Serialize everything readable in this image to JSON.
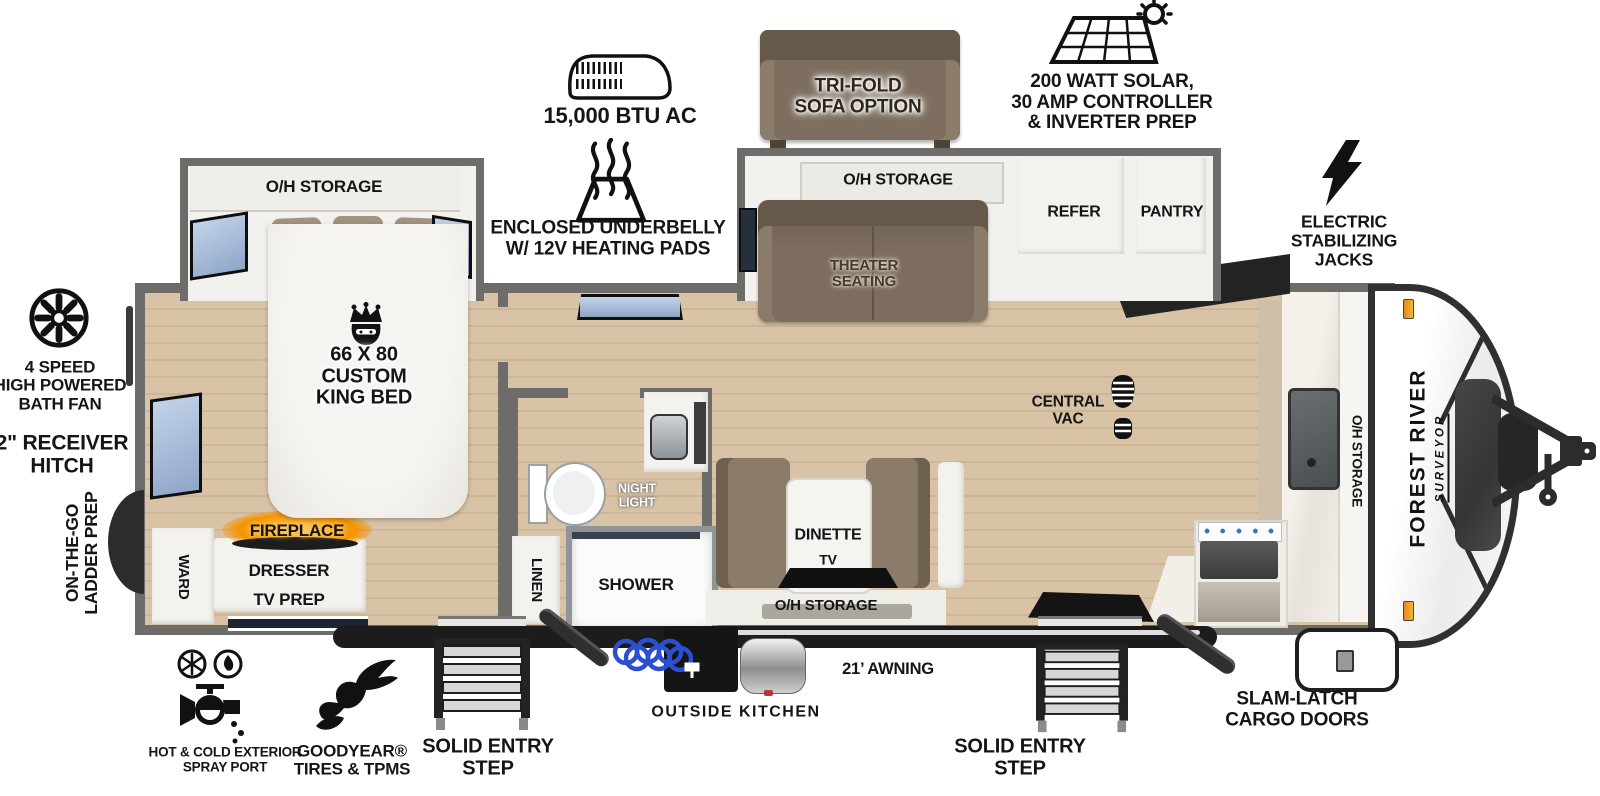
{
  "title": "Travel trailer floorplan",
  "colors": {
    "wall": "#6e6c68",
    "floor": "#d9c3a6",
    "floor_line": "#cdb698",
    "furniture_brown": "#7f7164",
    "window_blue": "#a9bdd9",
    "fireplace_orange": "#f59300",
    "accent_dark": "#1c1c1c"
  },
  "callouts": {
    "ac": "15,000 BTU AC",
    "underbelly": "ENCLOSED UNDERBELLY\nW/ 12V HEATING PADS",
    "trifold_sofa": "TRI-FOLD\nSOFA OPTION",
    "solar": "200 WATT SOLAR,\n30 AMP CONTROLLER\n& INVERTER PREP",
    "stabilizing_jacks": "ELECTRIC\nSTABILIZING\nJACKS",
    "bath_fan": "4 SPEED\nHIGH POWERED\nBATH FAN",
    "receiver_hitch": "2\" RECEIVER\nHITCH",
    "ladder_prep": "ON-THE-GO\nLADDER PREP",
    "spray_port": "HOT & COLD EXTERIOR\nSPRAY PORT",
    "tires": "GOODYEAR®\nTIRES & TPMS",
    "entry_step_left": "SOLID ENTRY\nSTEP",
    "outside_kitchen": "OUTSIDE KITCHEN",
    "awning": "21’ AWNING",
    "entry_step_right": "SOLID ENTRY\nSTEP",
    "cargo_doors": "SLAM-LATCH\nCARGO DOORS"
  },
  "interior": {
    "bedroom_oh_storage": "O/H STORAGE",
    "king_bed": "66 X 80\nCUSTOM\nKING BED",
    "fireplace": "FIREPLACE",
    "dresser": "DRESSER",
    "tv_prep": "TV PREP",
    "ward": "WARD",
    "linen": "LINEN",
    "shower": "SHOWER",
    "night_light": "NIGHT\nLIGHT",
    "dinette": "DINETTE",
    "dinette_tv": "TV",
    "dinette_oh_storage": "O/H STORAGE",
    "theater_oh_storage": "O/H STORAGE",
    "theater_seating": "THEATER\nSEATING",
    "refer": "REFER",
    "pantry": "PANTRY",
    "central_vac": "CENTRAL\nVAC",
    "kitchen_oh_storage": "O/H STORAGE"
  },
  "brand": {
    "name": "FOREST RIVER",
    "model": "SURVEYOR"
  }
}
